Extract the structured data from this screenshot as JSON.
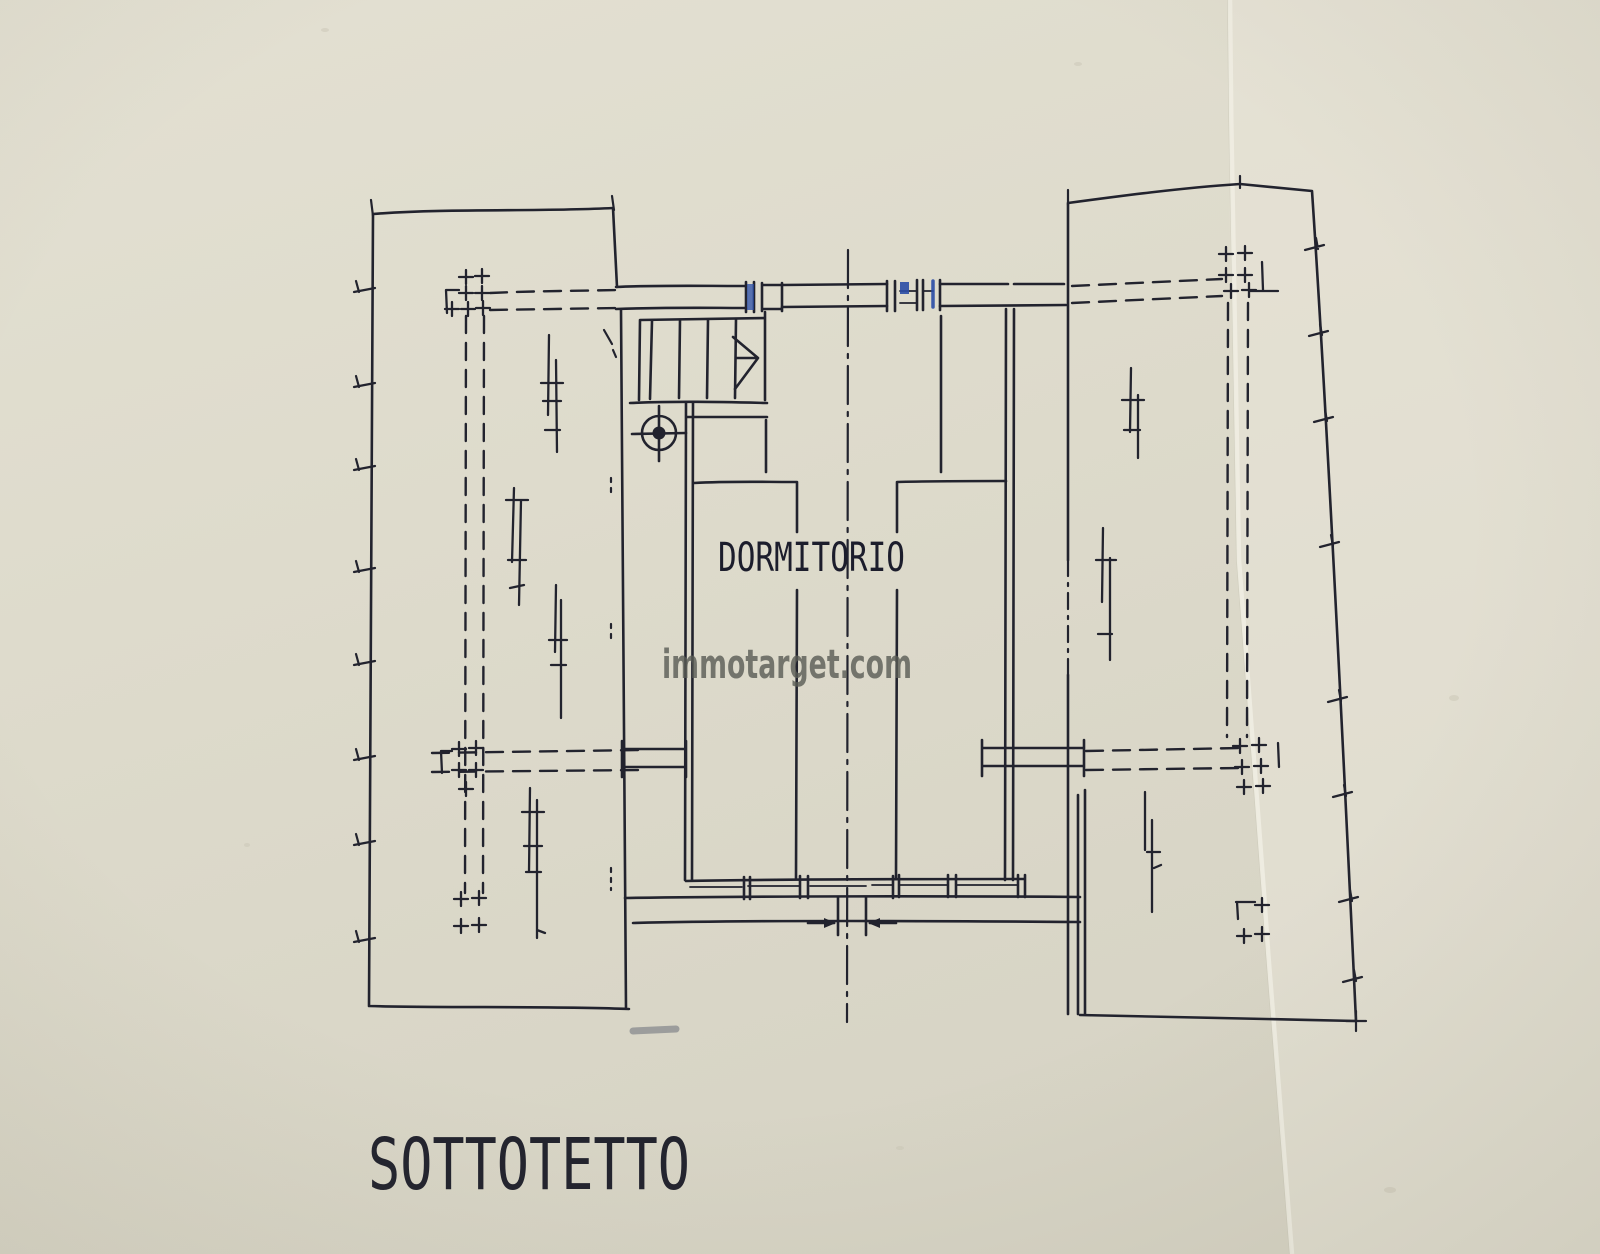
{
  "document": {
    "plan_title": "SOTTOTETTO",
    "room_label": "DORMITORIO",
    "watermark": "immotarget.com"
  },
  "colors": {
    "paper": "#dedbcc",
    "paper_light": "#e9e5d9",
    "ink": "#22232e",
    "blue_ink": "#2a4da6",
    "watermark_gray": "#5a5c55",
    "pencil_gray": "#888b8e"
  },
  "icons": [
    {
      "name": "stair-direction-arrow-icon",
      "meaning": "stair up direction"
    },
    {
      "name": "chimney-flue-icon",
      "meaning": "chimney / flue target symbol"
    }
  ]
}
